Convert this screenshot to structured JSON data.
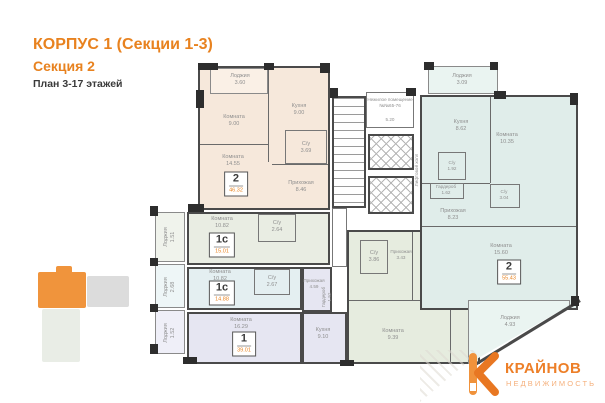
{
  "header": {
    "building": "КОРПУС 1 (Секции 1-3)",
    "section": "Секция 2",
    "floors": "План 3-17 этажей"
  },
  "apartments": [
    {
      "id": "apt-2-left",
      "badge": "2",
      "total_area": "46.32",
      "rooms": [
        {
          "name": "Лоджия",
          "area": "3.60"
        },
        {
          "name": "Комната",
          "area": "9.00"
        },
        {
          "name": "Кухня",
          "area": "9.00"
        },
        {
          "name": "Комната",
          "area": "14.55"
        },
        {
          "name": "С/у",
          "area": "3.69"
        },
        {
          "name": "Прихожая",
          "area": "8.46"
        }
      ]
    },
    {
      "id": "apt-1c-upper",
      "badge": "1с",
      "total_area": "15.01",
      "rooms": [
        {
          "name": "Лоджия",
          "area": "1.51"
        },
        {
          "name": "Комната",
          "area": "10.82"
        },
        {
          "name": "С/у",
          "area": "2.64"
        }
      ]
    },
    {
      "id": "apt-1c-lower",
      "badge": "1с",
      "total_area": "14.88",
      "rooms": [
        {
          "name": "Лоджия",
          "area": "2.68"
        },
        {
          "name": "Комната",
          "area": "10.82"
        },
        {
          "name": "С/у",
          "area": "2.67"
        }
      ]
    },
    {
      "id": "apt-1",
      "badge": "1",
      "total_area": "39.01",
      "rooms": [
        {
          "name": "Лоджия",
          "area": "1.52"
        },
        {
          "name": "Комната",
          "area": "16.29"
        },
        {
          "name": "Прихожая",
          "area": "4.59"
        },
        {
          "name": "Гардероб",
          "area": "1.52"
        },
        {
          "name": "Кухня",
          "area": "9.10"
        }
      ]
    },
    {
      "id": "apt-2e",
      "badge": "2е",
      "total_area": "41.15",
      "rooms": [
        {
          "name": "С/у",
          "area": "3.86"
        },
        {
          "name": "Прихожая",
          "area": "3.43"
        },
        {
          "name": "Кухня-гостиная",
          "area": "20.19"
        },
        {
          "name": "Комната",
          "area": "9.39"
        }
      ]
    },
    {
      "id": "apt-2-right",
      "badge": "2",
      "total_area": "55.43",
      "rooms": [
        {
          "name": "Лоджия",
          "area": "3.09"
        },
        {
          "name": "Кухня",
          "area": "8.62"
        },
        {
          "name": "Комната",
          "area": "10.35"
        },
        {
          "name": "С/у",
          "area": "1.92"
        },
        {
          "name": "Гардероб",
          "area": "1.62"
        },
        {
          "name": "С/у",
          "area": "3.04"
        },
        {
          "name": "Прихожая",
          "area": "8.23"
        },
        {
          "name": "Комната",
          "area": "15.60"
        },
        {
          "name": "Лоджия",
          "area": "4.93"
        }
      ]
    }
  ],
  "core": {
    "non_residential": {
      "line1": "Нежилое помещение",
      "line2": "№№65-76",
      "area": "5.20"
    },
    "elevator_hall": "Лифтовой холл"
  },
  "logo": {
    "brand": "КРАЙНОВ",
    "tagline": "НЕДВИЖИМОСТЬ"
  },
  "colors": {
    "accent": "#E8821F",
    "apartment_peach": "#F6E8DB",
    "apartment_sage": "#E9EDE3",
    "apartment_cyan": "#E4EFF1",
    "apartment_lavender": "#E6E6F2",
    "apartment_green": "#E6ECDF",
    "apartment_teal": "#E0EDEA",
    "wall": "#4A4A4A",
    "minimap_highlight": "#F0943C"
  }
}
